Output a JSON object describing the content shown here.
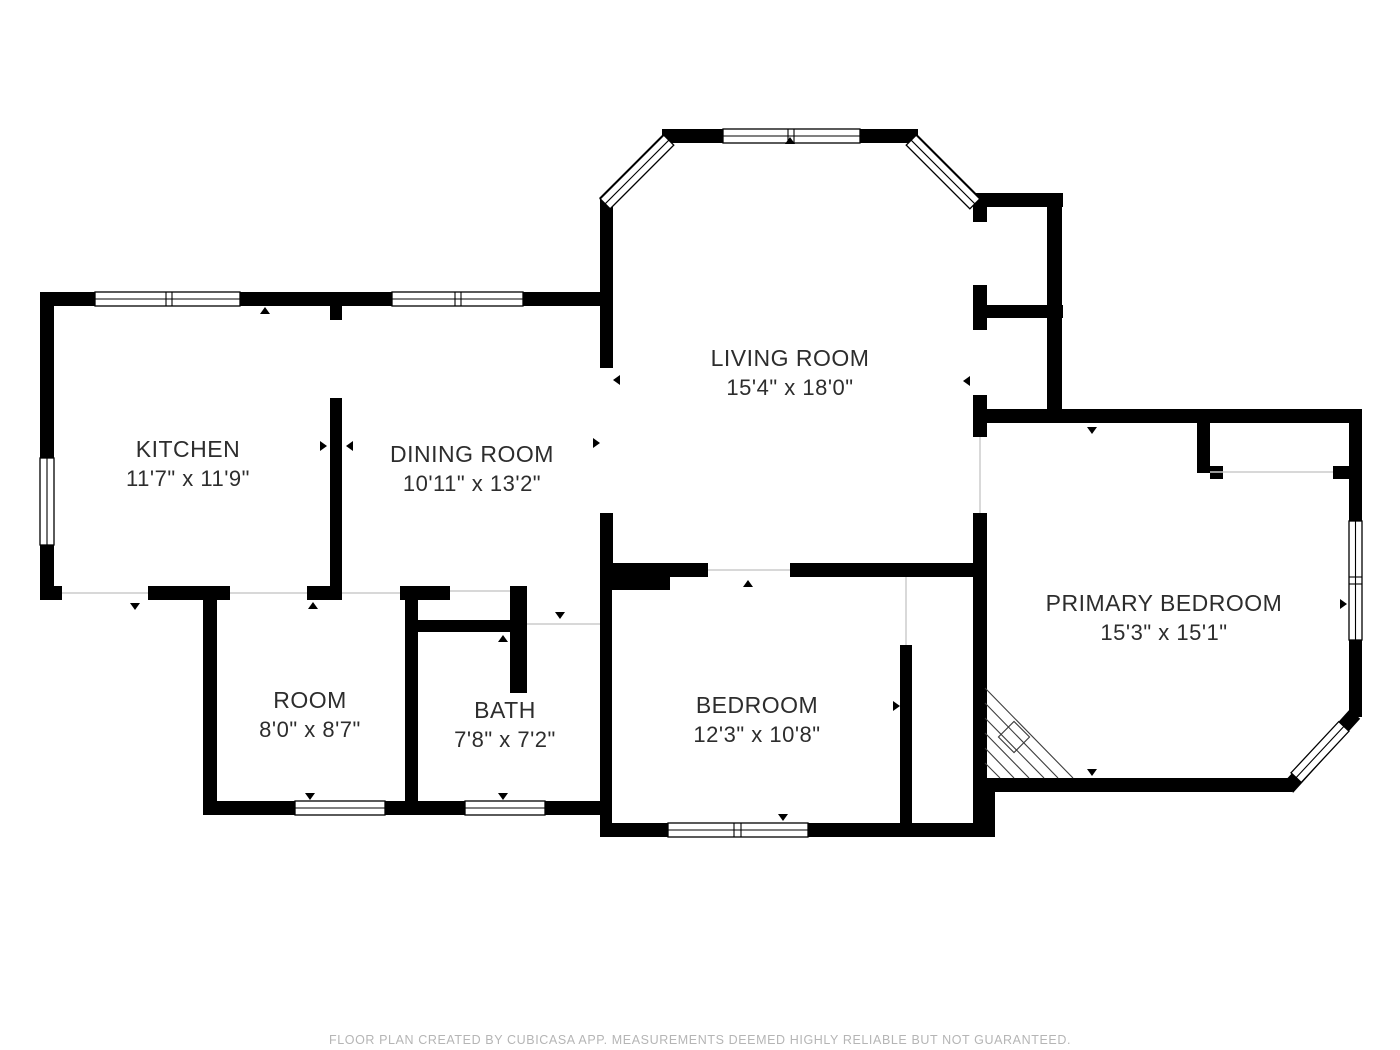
{
  "rooms": [
    {
      "id": "kitchen",
      "name": "KITCHEN",
      "dims": "11'7\" x 11'9\""
    },
    {
      "id": "dining-room",
      "name": "DINING ROOM",
      "dims": "10'11\" x 13'2\""
    },
    {
      "id": "living-room",
      "name": "LIVING ROOM",
      "dims": "15'4\" x 18'0\""
    },
    {
      "id": "primary-bedroom",
      "name": "PRIMARY BEDROOM",
      "dims": "15'3\" x 15'1\""
    },
    {
      "id": "room",
      "name": "ROOM",
      "dims": "8'0\" x 8'7\""
    },
    {
      "id": "bath",
      "name": "BATH",
      "dims": "7'8\" x 7'2\""
    },
    {
      "id": "bedroom",
      "name": "BEDROOM",
      "dims": "12'3\" x 10'8\""
    }
  ],
  "footer": "FLOOR PLAN CREATED BY CUBICASA APP. MEASUREMENTS DEEMED HIGHLY RELIABLE BUT NOT GUARANTEED.",
  "colors": {
    "wall": "#000000",
    "label": "#2d2d2d",
    "footer_text": "#b5b5b5",
    "background": "#ffffff",
    "opening_line": "#cccccc"
  }
}
